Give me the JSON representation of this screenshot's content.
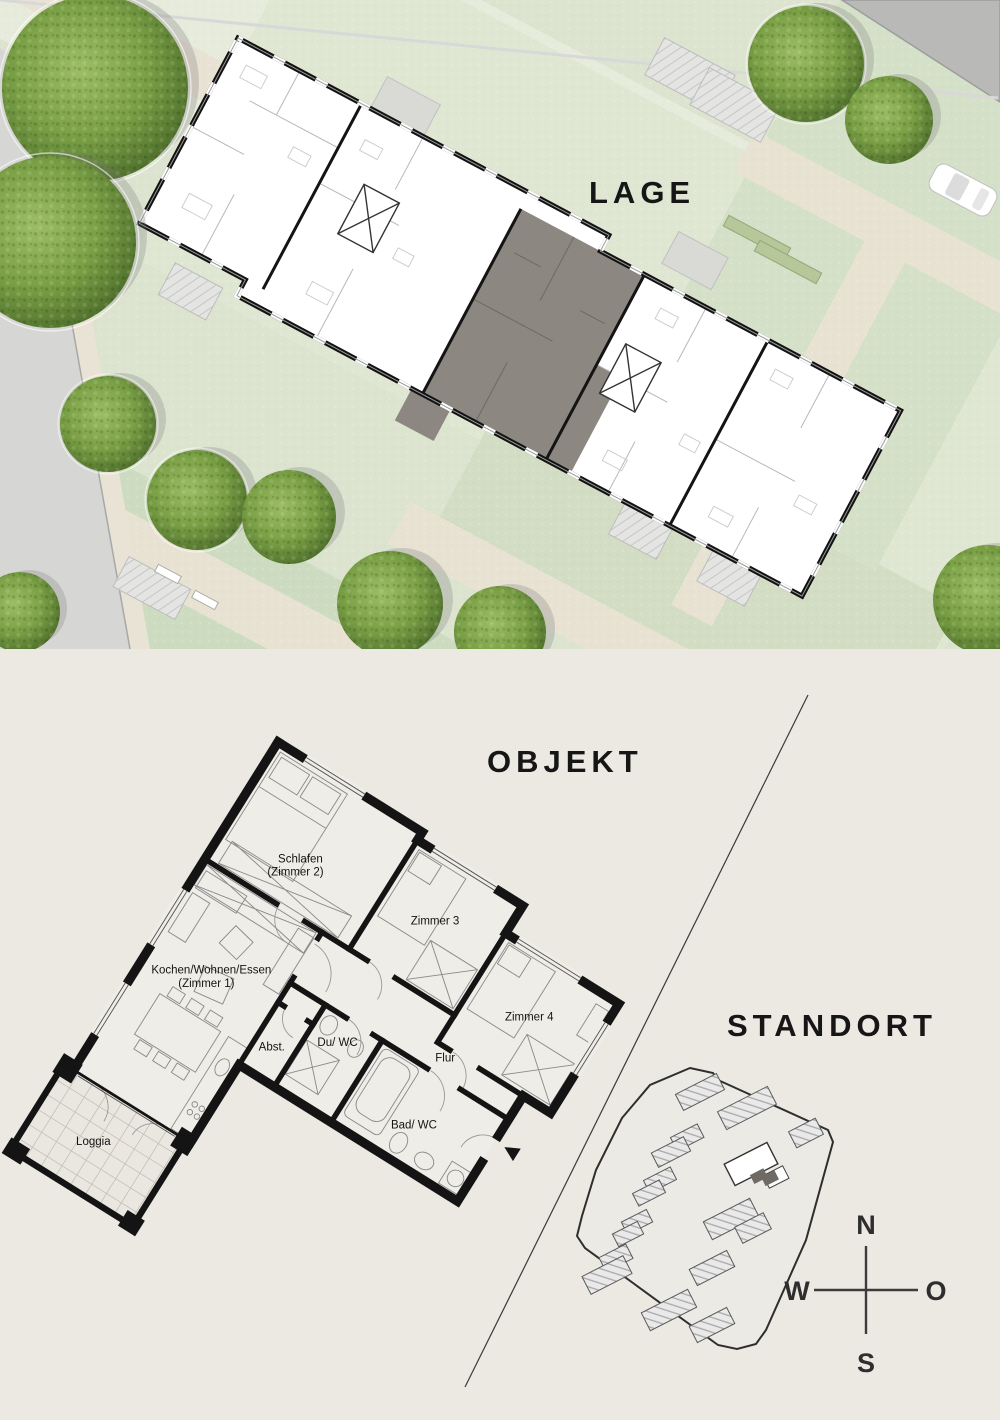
{
  "lage": {
    "title": "LAGE"
  },
  "objekt": {
    "title": "OBJEKT",
    "rooms": {
      "schlafen": {
        "line1": "Schlafen",
        "line2": "(Zimmer 2)"
      },
      "zimmer3": {
        "label": "Zimmer 3"
      },
      "zimmer4": {
        "label": "Zimmer 4"
      },
      "flur": {
        "label": "Flur"
      },
      "kochen": {
        "line1": "Kochen/Wohnen/Essen",
        "line2": "(Zimmer 1)"
      },
      "duwc": {
        "label": "Du/ WC"
      },
      "abst": {
        "label": "Abst."
      },
      "badwc": {
        "label": "Bad/ WC"
      },
      "loggia": {
        "label": "Loggia"
      }
    }
  },
  "standort": {
    "title": "STANDORT"
  },
  "compass": {
    "n": "N",
    "o": "O",
    "s": "S",
    "w": "W"
  },
  "colors": {
    "paper": "#ECE9E3",
    "ink": "#141414",
    "lawn": "#DCE4D0",
    "lawn_dark": "#CBDABD",
    "path_beige": "#E8E2D3",
    "road_grey": "#D6D6D5",
    "roof_grey": "#B9BAB8",
    "tree_green": "#6F9440",
    "highlight_unit": "#8C8781",
    "hatch_grey": "#A9A9A9"
  }
}
